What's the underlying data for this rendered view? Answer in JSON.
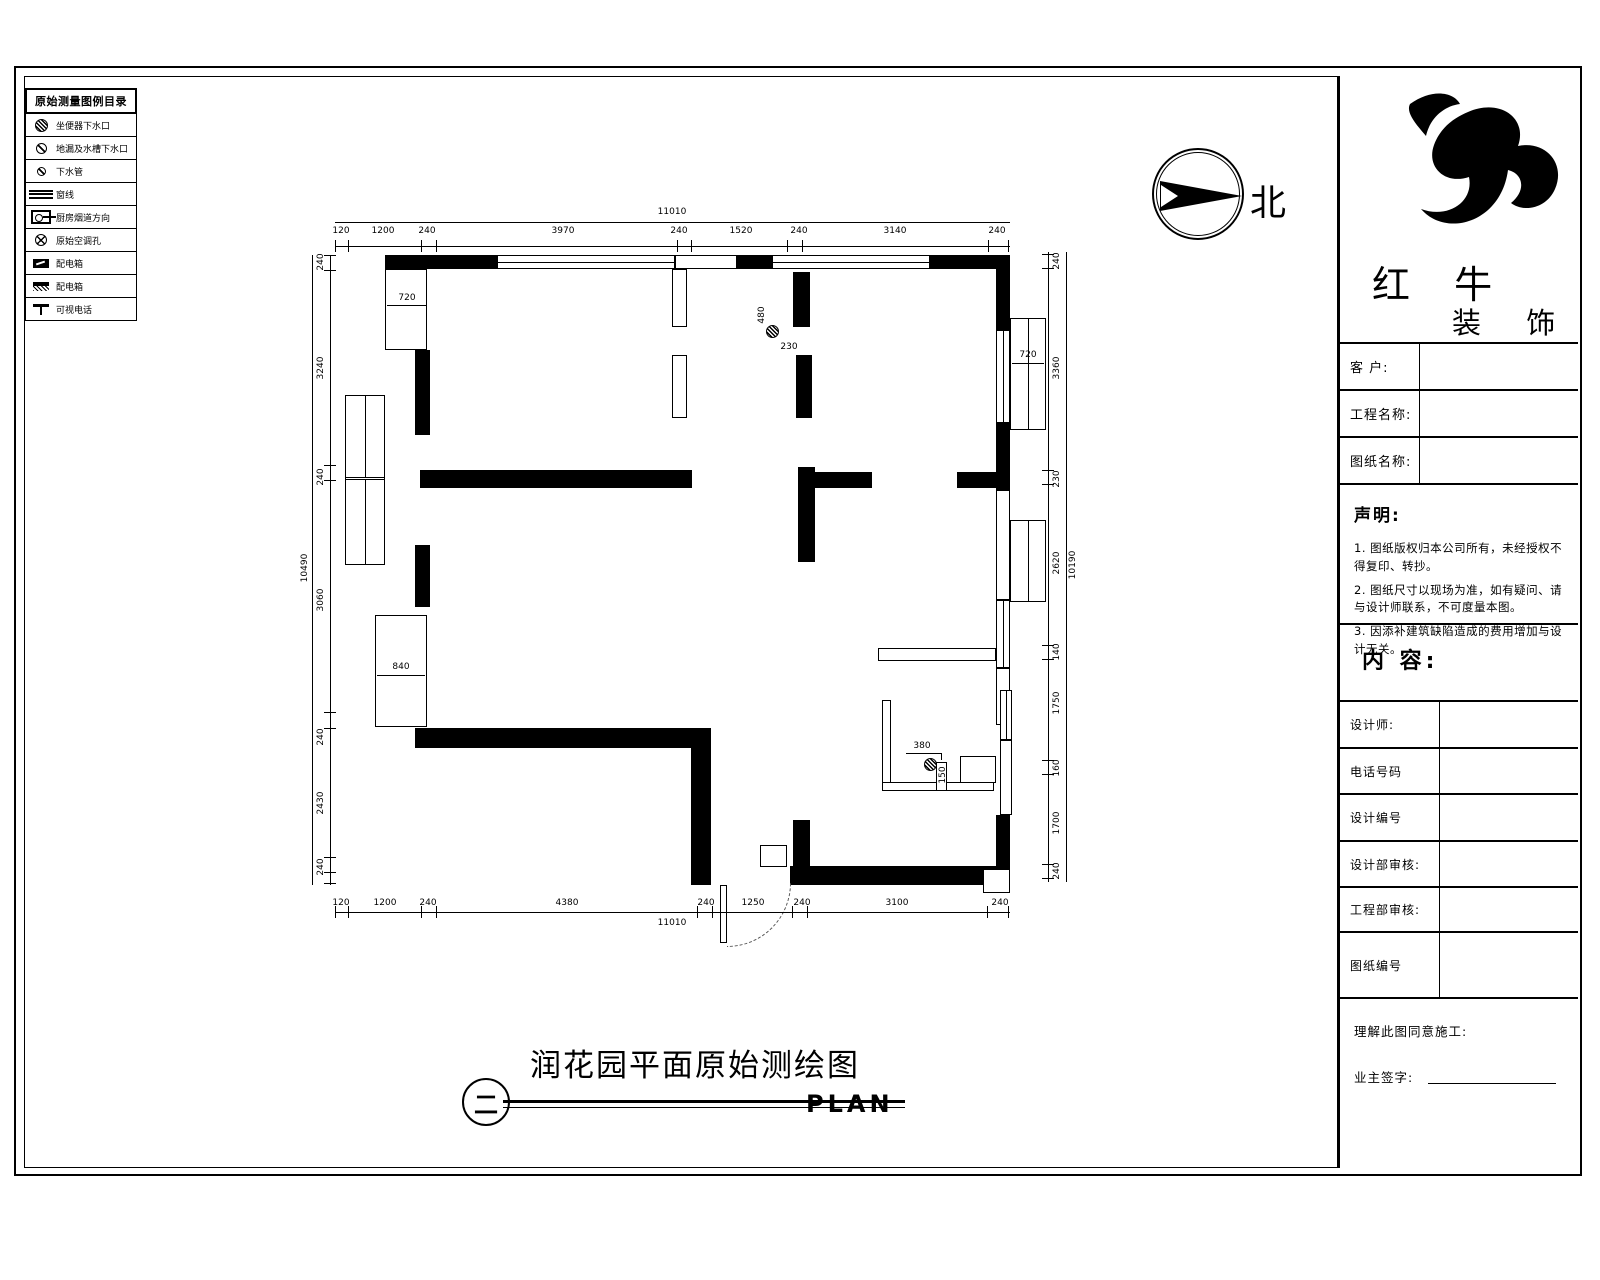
{
  "legend": {
    "title": "原始测量图例目录",
    "items": [
      {
        "icon": "toilet-drain-icon",
        "label": "坐便器下水口"
      },
      {
        "icon": "floor-drain-icon",
        "label": "地漏及水槽下水口"
      },
      {
        "icon": "drain-pipe-icon",
        "label": "下水管"
      },
      {
        "icon": "window-line-icon",
        "label": "窗线"
      },
      {
        "icon": "kitchen-flue-icon",
        "label": "厨房烟道方向"
      },
      {
        "icon": "ac-hole-icon",
        "label": "原始空调孔"
      },
      {
        "icon": "power-box-icon",
        "label": "配电箱"
      },
      {
        "icon": "power-box-2-icon",
        "label": "配电箱"
      },
      {
        "icon": "videophone-icon",
        "label": "可视电话"
      }
    ]
  },
  "north": {
    "label": "北"
  },
  "brand": {
    "name": "红 牛",
    "suffix": "装 饰"
  },
  "titleblock": {
    "client": "客  户:",
    "project": "工程名称:",
    "drawing": "图纸名称:",
    "statement_title": "声明:",
    "statements": [
      "1. 图纸版权归本公司所有，未经授权不得复印、转抄。",
      "2. 图纸尺寸以现场为准，如有疑问、请与设计师联系，不可度量本图。",
      "3. 因添补建筑缺陷造成的费用增加与设计无关。"
    ],
    "content": "内 容:",
    "designer": "设计师:",
    "phone": "电话号码",
    "design_no": "设计编号",
    "design_review": "设计部审核:",
    "eng_review": "工程部审核:",
    "sheet_no": "图纸编号",
    "agree": "理解此图同意施工:",
    "sign": "业主签字:"
  },
  "plan_title": {
    "cn": "润花园平面原始测绘图",
    "en": "PLAN",
    "bubble": "二"
  },
  "dims": {
    "top_overall": "11010",
    "top": [
      "120",
      "1200",
      "240",
      "3970",
      "240",
      "1520",
      "240",
      "3140",
      "240"
    ],
    "bottom": [
      "120",
      "1200",
      "240",
      "4380",
      "240",
      "1250",
      "240",
      "3100",
      "240"
    ],
    "bottom_overall": "11010",
    "left_overall": "10490",
    "left": [
      "240",
      "3240",
      "240",
      "3060",
      "240",
      "2430",
      "240"
    ],
    "right_overall": "10190",
    "right": [
      "240",
      "3360",
      "230",
      "2620",
      "140",
      "1750",
      "160",
      "1700",
      "240"
    ],
    "inner": {
      "closet_left": "720",
      "bay_right": "720",
      "bath_depth": "480",
      "bath_off": "230",
      "closet_840": "840",
      "toilet_380": "380",
      "toilet_150": "150"
    }
  }
}
